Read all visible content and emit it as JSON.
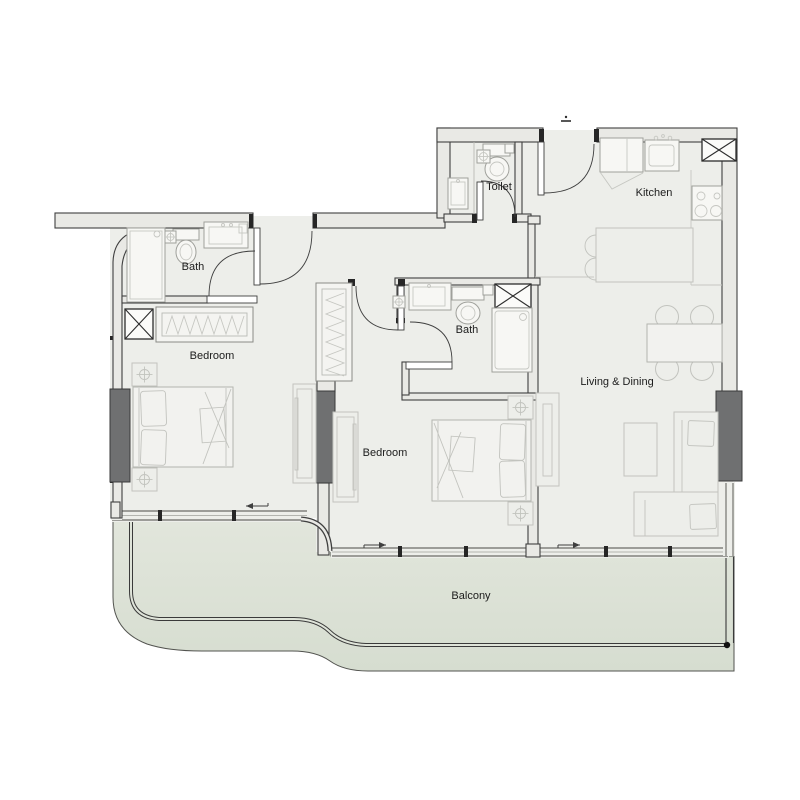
{
  "floorplan": {
    "labels": {
      "toilet": "Toilet",
      "kitchen": "Kitchen",
      "bath_top": "Bath",
      "bath_middle": "Bath",
      "bedroom_left": "Bedroom",
      "bedroom_middle": "Bedroom",
      "living_dining": "Living & Dining",
      "balcony": "Balcony"
    },
    "colors": {
      "floor": "#edeeea",
      "wall_fill": "#e9e9e5",
      "wall_line": "#3f3f3f",
      "balcony_fill": "#dfe4d9",
      "column_fill": "#6f7071",
      "furniture_line": "#c2c3be",
      "fixture_line": "#9fa09b",
      "label_text": "#1c1c1c"
    }
  }
}
